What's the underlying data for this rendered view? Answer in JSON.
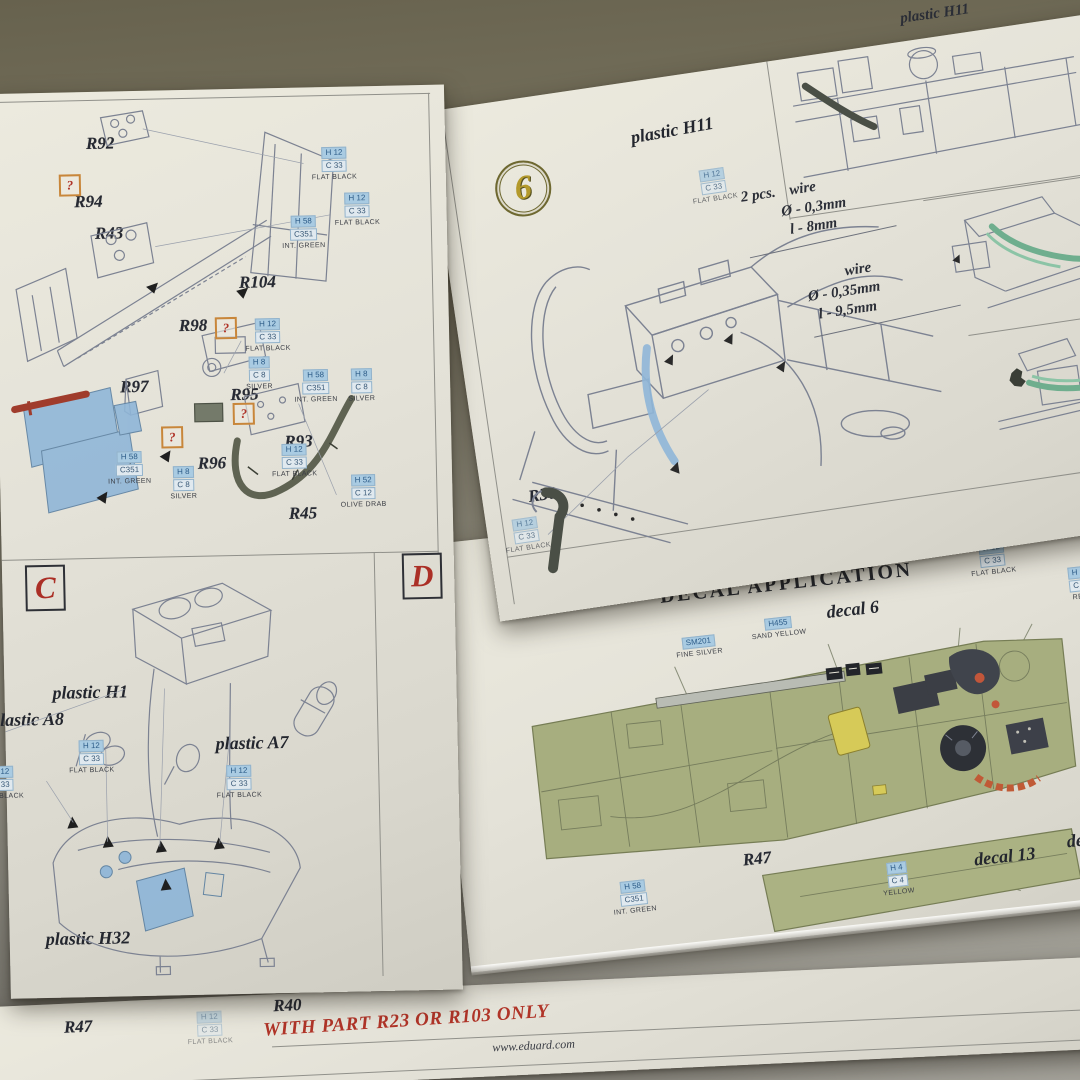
{
  "colors": {
    "accent_red": "#b03428",
    "callout_blue": "#a9cbe2",
    "photoetch_blue": "#8fb6d8",
    "wire_green": "#6fae8e",
    "olive_panel": "#a7ae7f",
    "decal_yellow": "#d6ca58",
    "paper": "#e4e2d8"
  },
  "paints": {
    "flat_black": {
      "h": "H 12",
      "c": "C 33",
      "name": "FLAT BLACK"
    },
    "int_green": {
      "h": "H 58",
      "c": "C351",
      "name": "INT. GREEN"
    },
    "silver": {
      "h": "H 8",
      "c": "C 8",
      "name": "SILVER"
    },
    "olive_drab": {
      "h": "H 52",
      "c": "C 12",
      "name": "OLIVE DRAB"
    },
    "red": {
      "h": "H 3",
      "c": "C 3",
      "name": "RED"
    },
    "yellow": {
      "h": "H 4",
      "c": "C 4",
      "name": "YELLOW"
    },
    "fine_silver": {
      "h": "SM201",
      "name": "FINE SILVER"
    },
    "sand_yellow": {
      "h": "H455",
      "name": "SAND YELLOW"
    }
  },
  "left_sheet": {
    "unknown_mark": "?",
    "sections": {
      "c": "C",
      "d": "D"
    },
    "parts": {
      "r92": "R92",
      "r94": "R94",
      "r43": "R43",
      "r104": "R104",
      "r98": "R98",
      "r97": "R97",
      "r95": "R95",
      "r96": "R96",
      "r93": "R93",
      "r45": "R45"
    },
    "plastic": {
      "h1": "plastic H1",
      "a8": "plastic A8",
      "a7": "plastic A7",
      "h32": "plastic H32"
    }
  },
  "right_sheet": {
    "step_number": "6",
    "plastic_h11": "plastic H11",
    "corner_label": "plastic H11",
    "wire_a": {
      "qty": "2 pcs.",
      "material": "wire",
      "diameter": "Ø - 0,3mm",
      "length": "l - 8mm"
    },
    "wire_b": {
      "material": "wire",
      "diameter": "Ø - 0,35mm",
      "length": "l - 9,5mm"
    },
    "part_r30": "R30"
  },
  "decal_sheet": {
    "title": "DECAL APPLICATION",
    "part_r47": "R47",
    "decal_6": "decal 6",
    "decal_13": "decal 13",
    "decal_7": "decal 7"
  },
  "bottom_sheet": {
    "part_r47": "R47",
    "part_r40": "R40",
    "note": "WITH PART R23 OR R103 ONLY",
    "website": "www.eduard.com"
  }
}
